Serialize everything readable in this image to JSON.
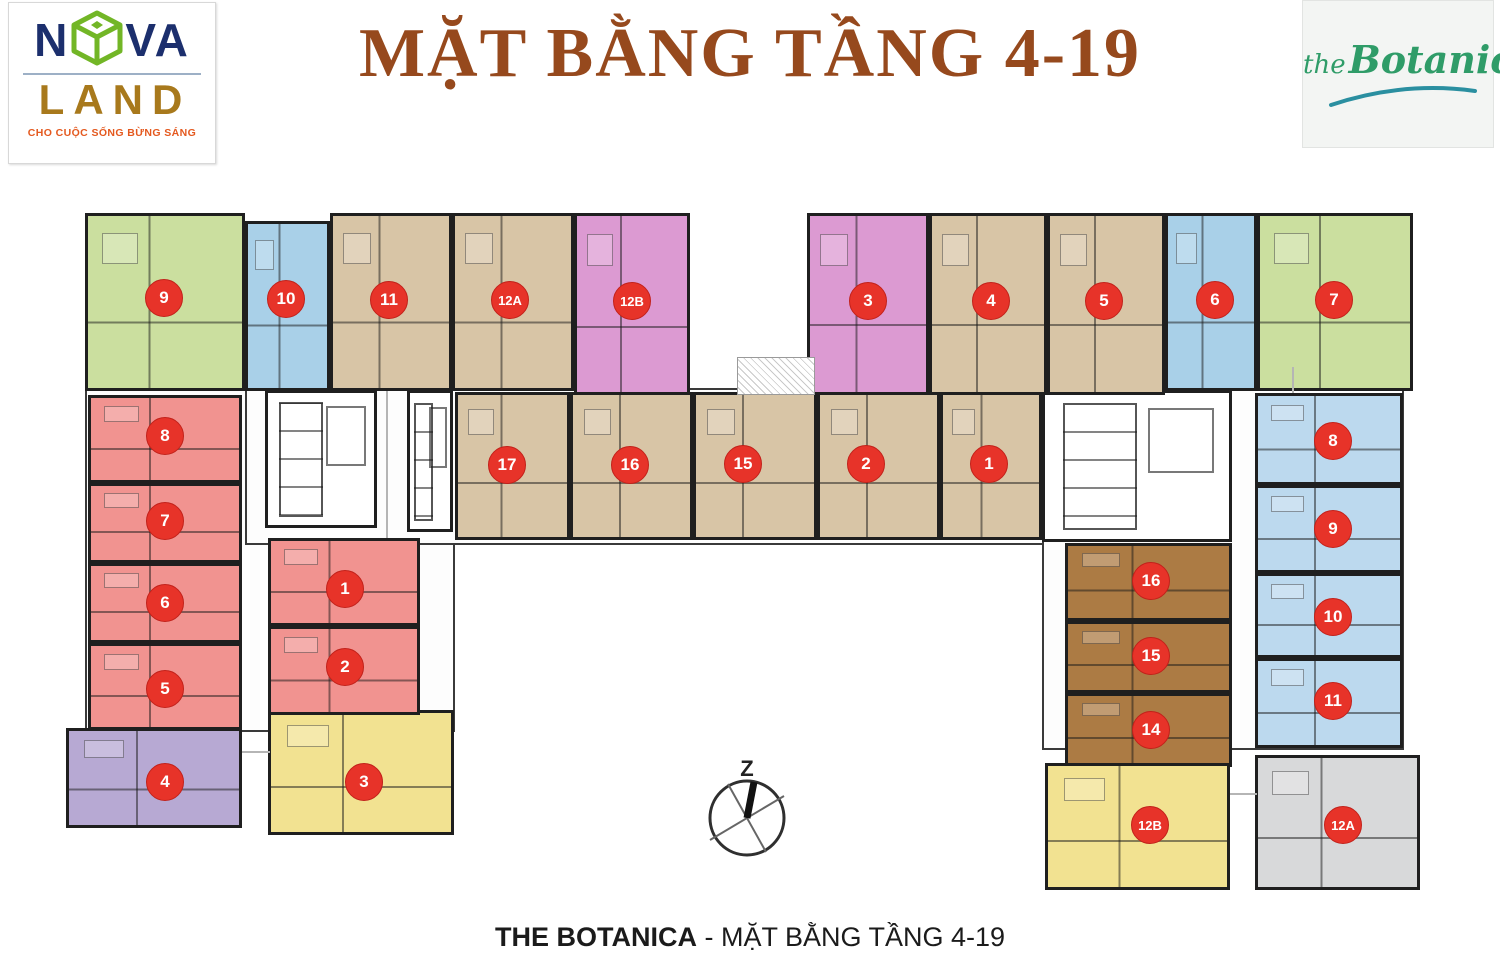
{
  "header": {
    "title": "MẶT BẰNG TẦNG 4-19",
    "novaland": {
      "n": "N",
      "va": "VA",
      "land": "LAND",
      "tagline": "CHO CUỘC SỐNG BỪNG SÁNG"
    },
    "botanica": {
      "the": "the",
      "name": "Botanica"
    }
  },
  "compass": {
    "label": "Z"
  },
  "footer": {
    "caption_bold": "THE BOTANICA",
    "caption_sep": " - ",
    "caption_rest": "MẶT BẰNG TẦNG 4-19"
  },
  "colors": {
    "title_text": "#96491d",
    "badge": "#e73329",
    "badge_text": "#ffffff",
    "wall": "#1f1f1f",
    "nova_blue": "#1c2f6d",
    "nova_gold": "#a8791c",
    "nova_green": "#72b626",
    "nova_tagline": "#e4591f",
    "botanica_green": "#2f9c68",
    "botanica_swoosh": "#2a8fa0",
    "caption_text": "#1b1b1b",
    "unit_green": "#cbdf9f",
    "unit_blue": "#a9d0e8",
    "unit_tan": "#d8c5a6",
    "unit_pink": "#dc9ad2",
    "unit_red": "#f19390",
    "unit_purple": "#b7a9d3",
    "unit_yellow": "#f2e291",
    "unit_brown": "#ac7b44",
    "unit_lightblue": "#bcd9ee",
    "unit_gray": "#d8d9da"
  },
  "units": [
    {
      "id": "top-9",
      "label": "9",
      "color": "unit_green"
    },
    {
      "id": "top-10",
      "label": "10",
      "color": "unit_blue"
    },
    {
      "id": "top-11",
      "label": "11",
      "color": "unit_tan"
    },
    {
      "id": "top-12A",
      "label": "12A",
      "color": "unit_tan"
    },
    {
      "id": "top-12B",
      "label": "12B",
      "color": "unit_pink"
    },
    {
      "id": "top-3",
      "label": "3",
      "color": "unit_pink"
    },
    {
      "id": "top-4",
      "label": "4",
      "color": "unit_tan"
    },
    {
      "id": "top-5",
      "label": "5",
      "color": "unit_tan"
    },
    {
      "id": "top-6",
      "label": "6",
      "color": "unit_blue"
    },
    {
      "id": "top-7",
      "label": "7",
      "color": "unit_green"
    },
    {
      "id": "left-8",
      "label": "8",
      "color": "unit_red"
    },
    {
      "id": "left-7",
      "label": "7",
      "color": "unit_red"
    },
    {
      "id": "left-6",
      "label": "6",
      "color": "unit_red"
    },
    {
      "id": "left-5",
      "label": "5",
      "color": "unit_red"
    },
    {
      "id": "left-4",
      "label": "4",
      "color": "unit_purple"
    },
    {
      "id": "left-3",
      "label": "3",
      "color": "unit_yellow"
    },
    {
      "id": "center-1",
      "label": "1",
      "color": "unit_red"
    },
    {
      "id": "center-2",
      "label": "2",
      "color": "unit_red"
    },
    {
      "id": "mid-17",
      "label": "17",
      "color": "unit_tan"
    },
    {
      "id": "mid-16",
      "label": "16",
      "color": "unit_tan"
    },
    {
      "id": "mid-15",
      "label": "15",
      "color": "unit_tan"
    },
    {
      "id": "mid-2",
      "label": "2",
      "color": "unit_tan"
    },
    {
      "id": "mid-1",
      "label": "1",
      "color": "unit_tan"
    },
    {
      "id": "right-16",
      "label": "16",
      "color": "unit_brown"
    },
    {
      "id": "right-15",
      "label": "15",
      "color": "unit_brown"
    },
    {
      "id": "right-14",
      "label": "14",
      "color": "unit_brown"
    },
    {
      "id": "right-8",
      "label": "8",
      "color": "unit_lightblue"
    },
    {
      "id": "right-9",
      "label": "9",
      "color": "unit_lightblue"
    },
    {
      "id": "right-10",
      "label": "10",
      "color": "unit_lightblue"
    },
    {
      "id": "right-11",
      "label": "11",
      "color": "unit_lightblue"
    },
    {
      "id": "bottom-12B",
      "label": "12B",
      "color": "unit_yellow"
    },
    {
      "id": "bottom-12A",
      "label": "12A",
      "color": "unit_gray"
    }
  ]
}
